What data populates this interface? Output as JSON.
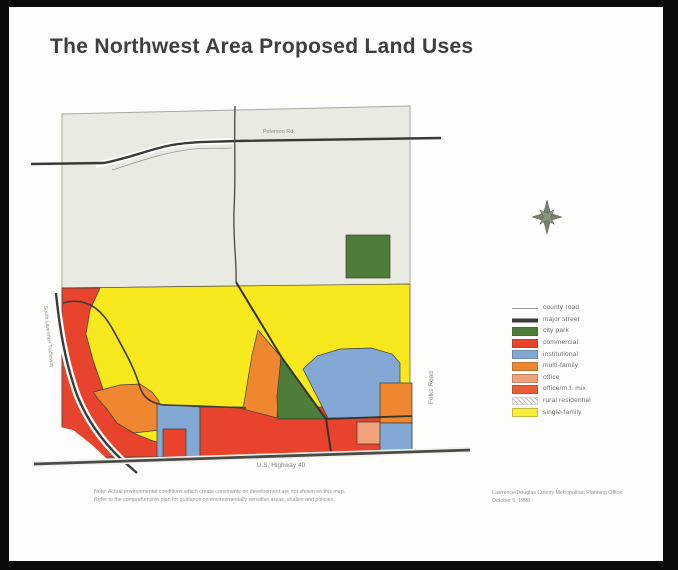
{
  "page": {
    "title": "The Northwest Area Proposed Land Uses"
  },
  "map": {
    "road_labels": {
      "top_road": "Peterson Rd",
      "bottom_highway": "U.S. Highway 40",
      "right_road": "Folks Road",
      "left_road": "South Lawrence Trafficway"
    },
    "zone_colors": {
      "single_family": "#f7e91e",
      "rural_residential": "#e9ebe3",
      "commercial": "#e8432c",
      "institutional": "#84a8d4",
      "multi_family": "#ef8630",
      "office": "#f2a27a",
      "office_mf_mix": "#ea5c35",
      "city_park": "#4e7d3a"
    },
    "icons": {
      "compass": "compass-rose-icon"
    }
  },
  "legend": {
    "items": [
      {
        "key": "county-road",
        "label": "county road",
        "swatch": "line-thin",
        "color": "#9a9a92"
      },
      {
        "key": "major-street",
        "label": "major street",
        "swatch": "line-thick",
        "color": "#3a3a36"
      },
      {
        "key": "city-park",
        "label": "city park",
        "swatch": "box",
        "color": "#4e7d3a"
      },
      {
        "key": "commercial",
        "label": "commercial",
        "swatch": "box",
        "color": "#e8432c"
      },
      {
        "key": "institutional",
        "label": "institutional",
        "swatch": "box",
        "color": "#84a8d4"
      },
      {
        "key": "multi-family",
        "label": "multi-family",
        "swatch": "box",
        "color": "#ef8630"
      },
      {
        "key": "office",
        "label": "office",
        "swatch": "box",
        "color": "#f2a27a"
      },
      {
        "key": "office-mf-mix",
        "label": "office/m.f. mix",
        "swatch": "box",
        "color": "#ea5c35"
      },
      {
        "key": "rural-residential",
        "label": "rural residential",
        "swatch": "hatch",
        "color": "#ffffff"
      },
      {
        "key": "single-family",
        "label": "single-family",
        "swatch": "box",
        "color": "#f8ec3a"
      }
    ]
  },
  "notes": {
    "disclaimer_line1": "Note: Actual environmental conditions which create constraints on development are not shown on this map.",
    "disclaimer_line2": "Refer to the comprehensive plan for guidance on environmentally sensitive areas, studies and policies."
  },
  "attribution": {
    "line1": "Lawrence/Douglas County Metropolitan Planning Office",
    "line2": "October 5, 1998"
  }
}
